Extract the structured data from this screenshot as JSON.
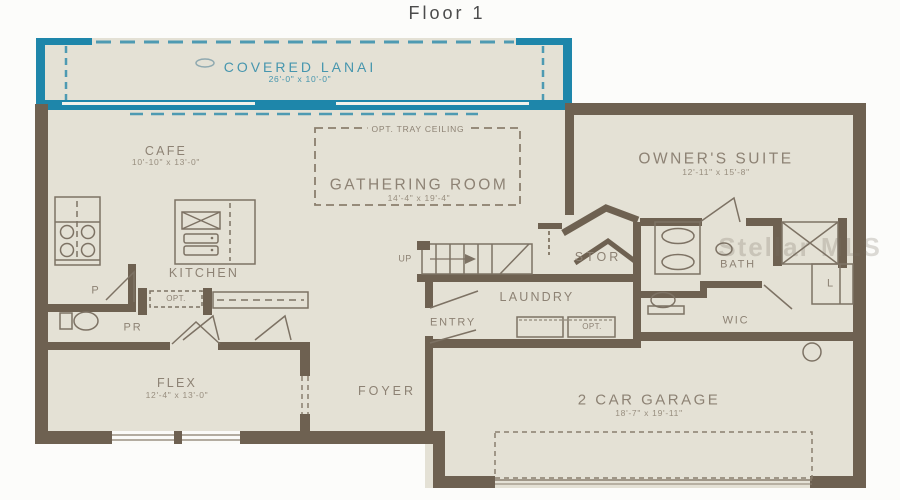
{
  "title": "Floor 1",
  "watermark": "Stellar MLS",
  "colors": {
    "lanai_accent": "#1e86aa",
    "wall": "#6e6151",
    "floor": "#e4e1d5",
    "label_text": "#8d8274",
    "lanai_label_text": "#4796ae"
  },
  "rooms": {
    "lanai": {
      "name": "COVERED LANAI",
      "dims": "26'-0\" x 10'-0\""
    },
    "cafe": {
      "name": "CAFE",
      "dims": "10'-10\" x 13'-0\""
    },
    "gathering": {
      "name": "GATHERING ROOM",
      "dims": "14'-4\" x 19'-4\"",
      "ceiling_note": "OPT. TRAY CEILING"
    },
    "owners_suite": {
      "name": "OWNER'S SUITE",
      "dims": "12'-11\" x 15'-8\""
    },
    "kitchen": {
      "name": "KITCHEN",
      "opt_label": "OPT."
    },
    "pantry": {
      "name": "P"
    },
    "powder": {
      "name": "PR"
    },
    "stairs": {
      "up_label": "UP"
    },
    "storage": {
      "name": "STOR"
    },
    "laundry": {
      "name": "LAUNDRY",
      "opt_label": "OPT."
    },
    "entry": {
      "name": "ENTRY"
    },
    "bath": {
      "name": "BATH"
    },
    "wic": {
      "name": "WIC"
    },
    "linen": {
      "name": "L"
    },
    "flex": {
      "name": "FLEX",
      "dims": "12'-4\" x 13'-0\""
    },
    "foyer": {
      "name": "FOYER"
    },
    "garage": {
      "name": "2 CAR GARAGE",
      "dims": "18'-7\" x 19'-11\""
    }
  }
}
